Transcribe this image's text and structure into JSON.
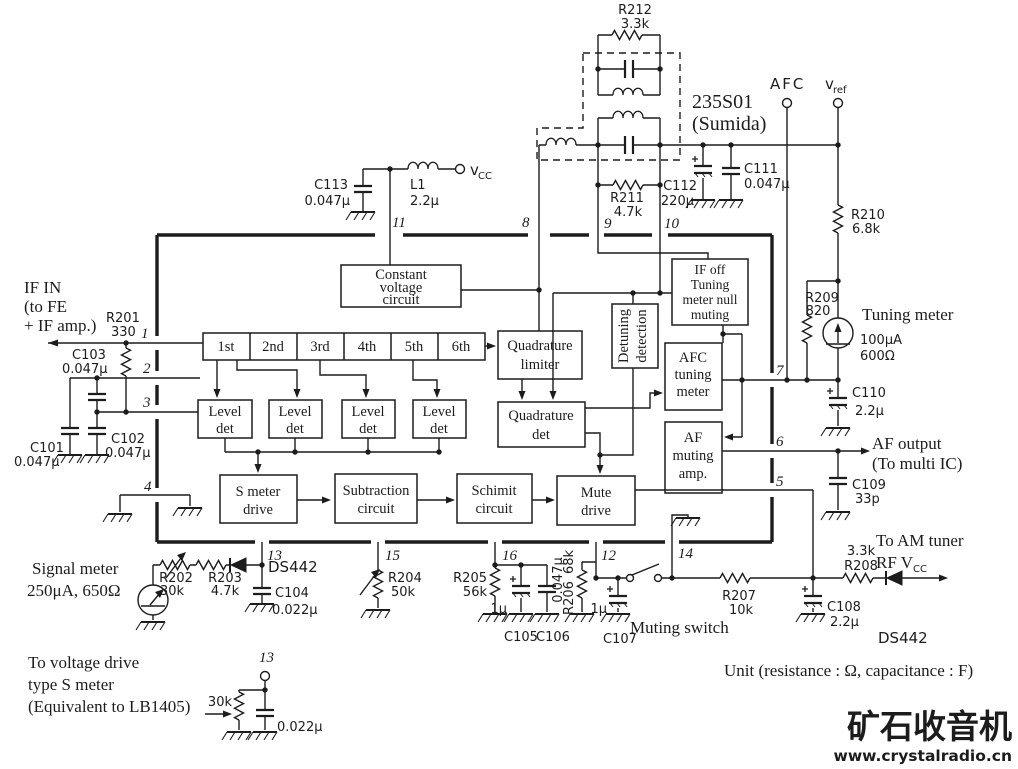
{
  "colors": {
    "ink": "#1c1c1c",
    "logo": "#17366b"
  },
  "logo": {
    "name": "矿石收音机",
    "url": "www.crystalradio.cn"
  },
  "notes": {
    "unit": "Unit (resistance : Ω, capacitance : F)",
    "transformer": "235S01",
    "transformer_maker": "(Sumida)",
    "muting_switch": "Muting switch",
    "if_in": [
      "IF IN",
      "(to FE",
      "+ IF amp.)"
    ],
    "signal_meter": "Signal meter",
    "signal_meter_spec": "250μA, 650Ω",
    "tuning_meter": "Tuning meter",
    "tuning_meter_current": "100μA",
    "tuning_meter_res": "600Ω",
    "af_output": [
      "AF output",
      "(To multi IC)"
    ],
    "am_tuner": "To AM tuner",
    "rf_v": "RF V",
    "rf_v_sub": "CC",
    "s_meter_alt": [
      "To voltage drive",
      "type S meter",
      "(Equivalent to LB1405)"
    ],
    "afc": "AFC",
    "v": "v",
    "vref_sub": "ref",
    "vcc_sub": "CC"
  },
  "ic": {
    "pins": {
      "top": [
        "11",
        "8",
        "9",
        "10"
      ],
      "left": [
        "1",
        "2",
        "3",
        "4"
      ],
      "right": [
        "7",
        "6",
        "5"
      ],
      "bottom": [
        "13",
        "15",
        "16",
        "12",
        "14"
      ],
      "sub": "13"
    },
    "blocks": {
      "constant_voltage": [
        "Constant",
        "voltage",
        "circuit"
      ],
      "stages": [
        "1st",
        "2nd",
        "3rd",
        "4th",
        "5th",
        "6th"
      ],
      "level_det": [
        "Level",
        "det"
      ],
      "quad_limiter": [
        "Quadrature",
        "limiter"
      ],
      "quad_det": [
        "Quadrature",
        "det"
      ],
      "detuning": [
        "Detuning",
        "detection"
      ],
      "if_off": [
        "IF off",
        "Tuning",
        "meter null",
        "muting"
      ],
      "afc_meter": [
        "AFC",
        "tuning",
        "meter"
      ],
      "af_muting": [
        "AF",
        "muting",
        "amp."
      ],
      "s_meter_drive": [
        "S meter",
        "drive"
      ],
      "subtraction": [
        "Subtraction",
        "circuit"
      ],
      "schimit": [
        "Schimit",
        "circuit"
      ],
      "mute_drive": [
        "Mute",
        "drive"
      ]
    }
  },
  "components": {
    "r201": {
      "ref": "R201",
      "value": "330"
    },
    "r202": {
      "ref": "R202",
      "value": "30k"
    },
    "r203": {
      "ref": "R203",
      "value": "4.7k"
    },
    "r204": {
      "ref": "R204",
      "value": "50k"
    },
    "r205": {
      "ref": "R205",
      "value": "56k"
    },
    "r206": {
      "ref": "R206",
      "value": "68k"
    },
    "r207": {
      "ref": "R207",
      "value": "10k"
    },
    "r208": {
      "ref": "R208",
      "value": "3.3k"
    },
    "r209": {
      "ref": "R209",
      "value": "820"
    },
    "r210": {
      "ref": "R210",
      "value": "6.8k"
    },
    "r211": {
      "ref": "R211",
      "value": "4.7k"
    },
    "r212": {
      "ref": "R212",
      "value": "3.3k"
    },
    "c101": {
      "ref": "C101",
      "value": "0.047μ"
    },
    "c102": {
      "ref": "C102",
      "value": "0.047μ"
    },
    "c103": {
      "ref": "C103",
      "value": "0.047μ"
    },
    "c104": {
      "ref": "C104",
      "value": "0.022μ"
    },
    "c105": {
      "ref": "C105",
      "value": "1μ"
    },
    "c106": {
      "ref": "C106",
      "value": "0.047μ"
    },
    "c107": {
      "ref": "C107",
      "value": "1μ"
    },
    "c108": {
      "ref": "C108",
      "value": "2.2μ"
    },
    "c109": {
      "ref": "C109",
      "value": "33p"
    },
    "c110": {
      "ref": "C110",
      "value": "2.2μ"
    },
    "c111": {
      "ref": "C111",
      "value": "0.047μ"
    },
    "c112": {
      "ref": "C112",
      "value": "220μ"
    },
    "c113": {
      "ref": "C113",
      "value": "0.047μ"
    },
    "l1": {
      "ref": "L1",
      "value": "2.2μ"
    },
    "d1": {
      "ref": "DS442"
    },
    "d2": {
      "ref": "DS442"
    },
    "pot": {
      "value": "30k"
    },
    "sub_cap": {
      "value": "0.022μ"
    }
  }
}
